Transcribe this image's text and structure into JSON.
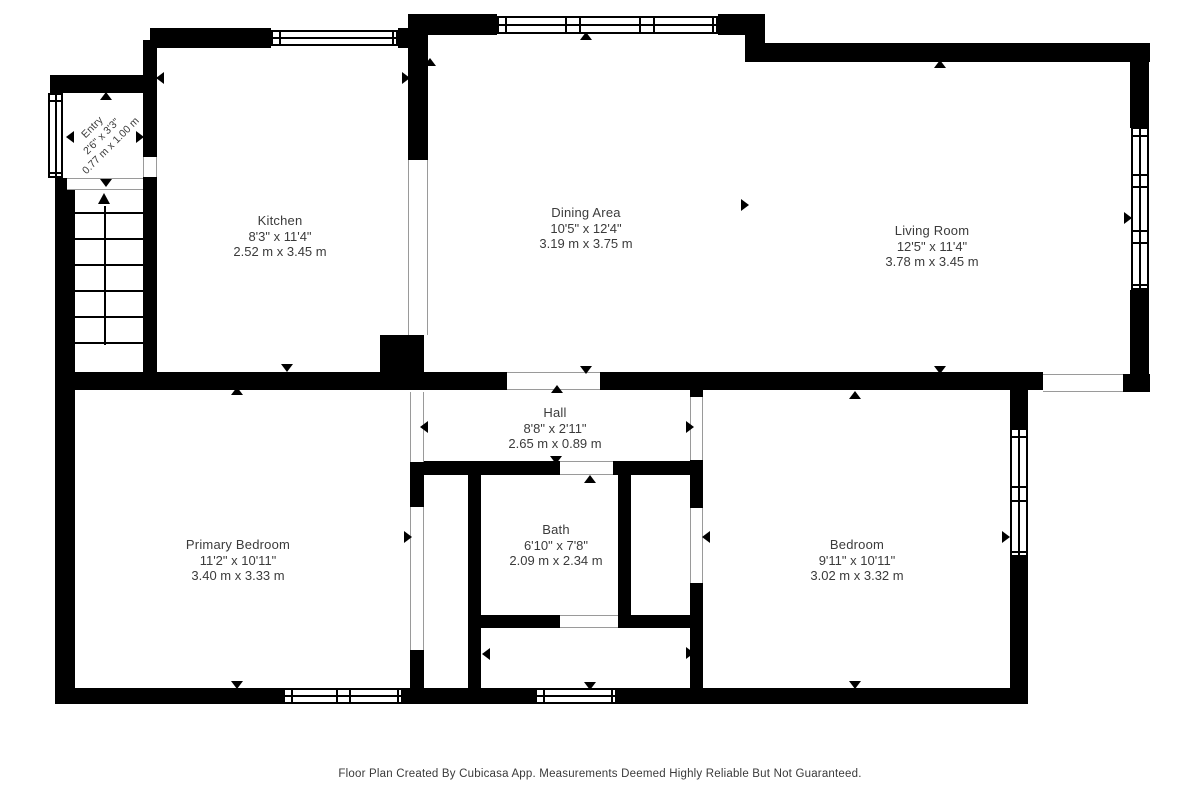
{
  "footer": "Floor Plan Created By Cubicasa App. Measurements Deemed Highly Reliable But Not Guaranteed.",
  "rooms": {
    "entry": {
      "name": "Entry",
      "imperial": "2'6\" x 3'3\"",
      "metric": "0.77 m x 1.00 m"
    },
    "kitchen": {
      "name": "Kitchen",
      "imperial": "8'3\" x 11'4\"",
      "metric": "2.52 m x 3.45 m"
    },
    "dining": {
      "name": "Dining Area",
      "imperial": "10'5\" x 12'4\"",
      "metric": "3.19 m x 3.75 m"
    },
    "living": {
      "name": "Living Room",
      "imperial": "12'5\" x 11'4\"",
      "metric": "3.78 m x 3.45 m"
    },
    "hall": {
      "name": "Hall",
      "imperial": "8'8\" x 2'11\"",
      "metric": "2.65 m x 0.89 m"
    },
    "primary": {
      "name": "Primary Bedroom",
      "imperial": "11'2\" x 10'11\"",
      "metric": "3.40 m x 3.33 m"
    },
    "bath": {
      "name": "Bath",
      "imperial": "6'10\" x 7'8\"",
      "metric": "2.09 m x 2.34 m"
    },
    "bedroom": {
      "name": "Bedroom",
      "imperial": "9'11\" x 10'11\"",
      "metric": "3.02 m x 3.32 m"
    }
  },
  "plan": {
    "wall_color": "#000000",
    "opening_line_color": "#9a9a9a",
    "walls": [
      [
        408,
        14,
        89,
        21
      ],
      [
        718,
        14,
        47,
        21
      ],
      [
        745,
        14,
        20,
        48
      ],
      [
        760,
        43,
        390,
        19
      ],
      [
        1130,
        43,
        19,
        85
      ],
      [
        1130,
        290,
        19,
        84
      ],
      [
        1123,
        374,
        27,
        18
      ],
      [
        600,
        372,
        443,
        18
      ],
      [
        150,
        28,
        121,
        20
      ],
      [
        398,
        28,
        22,
        20
      ],
      [
        408,
        35,
        20,
        125
      ],
      [
        50,
        75,
        100,
        18
      ],
      [
        55,
        178,
        20,
        526
      ],
      [
        143,
        40,
        14,
        117
      ],
      [
        143,
        177,
        14,
        196
      ],
      [
        55,
        372,
        452,
        18
      ],
      [
        380,
        335,
        44,
        37
      ],
      [
        55,
        688,
        228,
        16
      ],
      [
        403,
        688,
        132,
        16
      ],
      [
        617,
        688,
        411,
        16
      ],
      [
        1010,
        378,
        18,
        50
      ],
      [
        1010,
        557,
        18,
        147
      ],
      [
        410,
        462,
        14,
        45
      ],
      [
        410,
        650,
        14,
        54
      ],
      [
        410,
        461,
        150,
        14
      ],
      [
        613,
        461,
        90,
        14
      ],
      [
        468,
        461,
        13,
        243
      ],
      [
        480,
        615,
        80,
        13
      ],
      [
        618,
        461,
        13,
        157
      ],
      [
        618,
        615,
        82,
        13
      ],
      [
        690,
        372,
        13,
        25
      ],
      [
        690,
        460,
        13,
        48
      ],
      [
        690,
        583,
        13,
        121
      ]
    ],
    "windows": [
      {
        "x": 271,
        "y": 30,
        "w": 127,
        "h": 16,
        "axis": "h",
        "bars": [
          6,
          119
        ]
      },
      {
        "x": 497,
        "y": 16,
        "w": 221,
        "h": 18,
        "axis": "h",
        "bars": [
          6,
          66,
          80,
          140,
          154,
          213
        ]
      },
      {
        "x": 1131,
        "y": 127,
        "w": 18,
        "h": 163,
        "axis": "v",
        "bars": [
          6,
          45,
          57,
          101,
          113,
          155
        ]
      },
      {
        "x": 1010,
        "y": 428,
        "w": 18,
        "h": 129,
        "axis": "v",
        "bars": [
          6,
          56,
          70,
          121
        ]
      },
      {
        "x": 283,
        "y": 688,
        "w": 120,
        "h": 16,
        "axis": "h",
        "bars": [
          6,
          51,
          64,
          112
        ]
      },
      {
        "x": 535,
        "y": 688,
        "w": 82,
        "h": 16,
        "axis": "h",
        "bars": [
          6,
          74
        ]
      },
      {
        "x": 48,
        "y": 93,
        "w": 15,
        "h": 85,
        "axis": "v",
        "bars": [
          5,
          77
        ]
      }
    ],
    "openings": [
      {
        "x": 507,
        "y": 372,
        "w": 93,
        "h": 18,
        "axis": "h"
      },
      {
        "x": 1043,
        "y": 374,
        "w": 80,
        "h": 18,
        "axis": "h"
      },
      {
        "x": 560,
        "y": 461,
        "w": 53,
        "h": 14,
        "axis": "h"
      },
      {
        "x": 67,
        "y": 178,
        "w": 76,
        "h": 12,
        "axis": "h"
      },
      {
        "x": 410,
        "y": 392,
        "w": 14,
        "h": 70,
        "axis": "v"
      },
      {
        "x": 410,
        "y": 507,
        "w": 14,
        "h": 143,
        "axis": "v"
      },
      {
        "x": 690,
        "y": 397,
        "w": 13,
        "h": 63,
        "axis": "v"
      },
      {
        "x": 690,
        "y": 508,
        "w": 13,
        "h": 75,
        "axis": "v"
      },
      {
        "x": 143,
        "y": 157,
        "w": 14,
        "h": 20,
        "axis": "v"
      },
      {
        "x": 560,
        "y": 615,
        "w": 58,
        "h": 13,
        "axis": "h"
      },
      {
        "x": 408,
        "y": 160,
        "w": 20,
        "h": 175,
        "axis": "v"
      }
    ],
    "markers": [
      {
        "x": 106,
        "y": 96,
        "dir": "up"
      },
      {
        "x": 70,
        "y": 137,
        "dir": "left"
      },
      {
        "x": 140,
        "y": 137,
        "dir": "right"
      },
      {
        "x": 106,
        "y": 183,
        "dir": "down"
      },
      {
        "x": 160,
        "y": 78,
        "dir": "left"
      },
      {
        "x": 406,
        "y": 78,
        "dir": "right"
      },
      {
        "x": 287,
        "y": 368,
        "dir": "down"
      },
      {
        "x": 430,
        "y": 62,
        "dir": "up"
      },
      {
        "x": 586,
        "y": 36,
        "dir": "up"
      },
      {
        "x": 586,
        "y": 370,
        "dir": "down"
      },
      {
        "x": 745,
        "y": 205,
        "dir": "right"
      },
      {
        "x": 940,
        "y": 64,
        "dir": "up"
      },
      {
        "x": 1128,
        "y": 218,
        "dir": "right"
      },
      {
        "x": 557,
        "y": 389,
        "dir": "up"
      },
      {
        "x": 556,
        "y": 460,
        "dir": "down"
      },
      {
        "x": 424,
        "y": 427,
        "dir": "left"
      },
      {
        "x": 690,
        "y": 427,
        "dir": "right"
      },
      {
        "x": 68,
        "y": 537,
        "dir": "left"
      },
      {
        "x": 408,
        "y": 537,
        "dir": "right"
      },
      {
        "x": 237,
        "y": 391,
        "dir": "up"
      },
      {
        "x": 237,
        "y": 685,
        "dir": "down"
      },
      {
        "x": 706,
        "y": 537,
        "dir": "left"
      },
      {
        "x": 1006,
        "y": 537,
        "dir": "right"
      },
      {
        "x": 855,
        "y": 395,
        "dir": "up"
      },
      {
        "x": 855,
        "y": 685,
        "dir": "down"
      },
      {
        "x": 940,
        "y": 370,
        "dir": "down"
      },
      {
        "x": 590,
        "y": 479,
        "dir": "up"
      },
      {
        "x": 486,
        "y": 654,
        "dir": "left"
      },
      {
        "x": 690,
        "y": 653,
        "dir": "right"
      },
      {
        "x": 590,
        "y": 686,
        "dir": "down"
      }
    ],
    "stairs": {
      "x": 75,
      "y": 190,
      "w": 68,
      "h": 155,
      "treads": [
        22,
        48,
        74,
        100,
        126,
        152
      ],
      "center_x": 29,
      "line_top": 16,
      "line_height": 139,
      "arrow": {
        "left": 23,
        "top": 3,
        "half": 6,
        "len": 11
      }
    }
  }
}
